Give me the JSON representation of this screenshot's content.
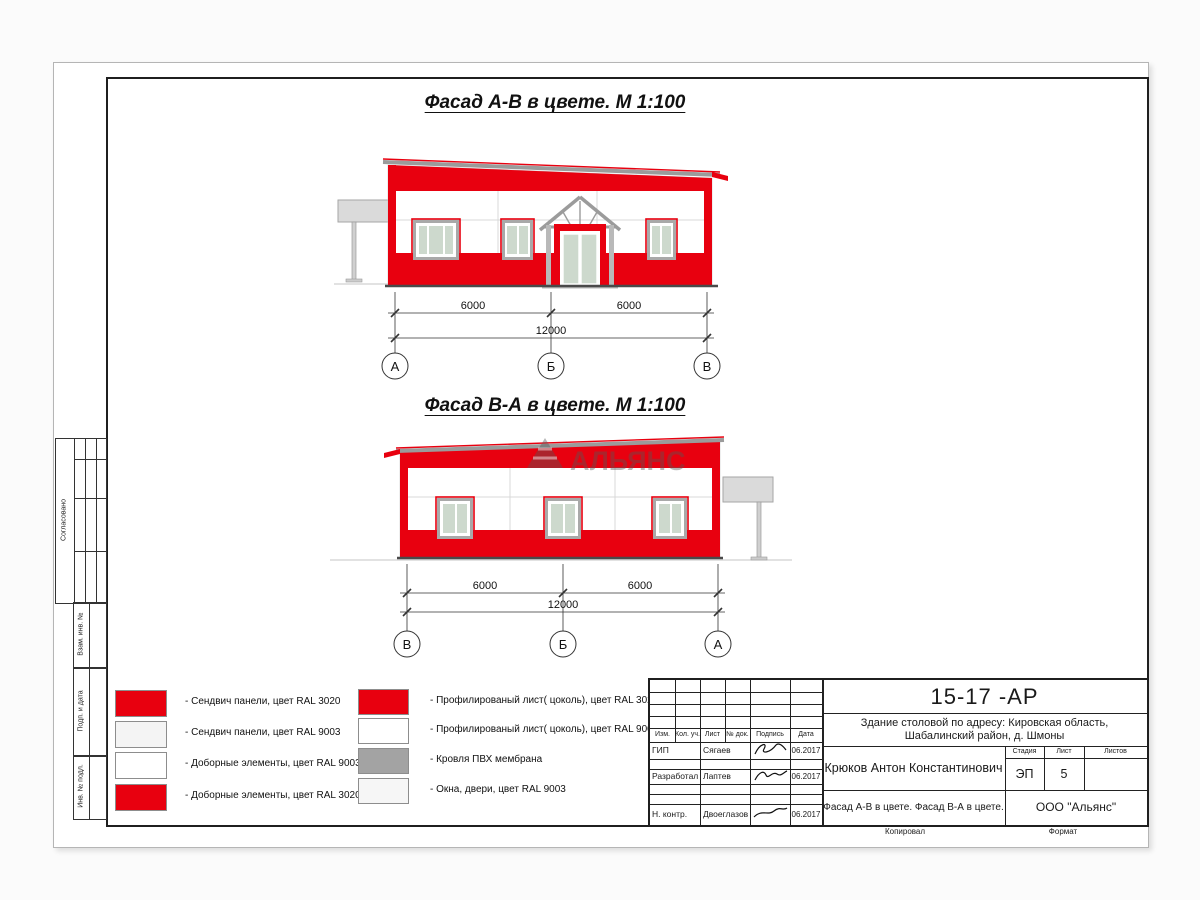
{
  "sheet": {
    "facade1": {
      "title": "Фасад А-В в цвете.  М 1:100",
      "dims": [
        "6000",
        "6000",
        "12000"
      ],
      "axes": [
        "А",
        "Б",
        "В"
      ]
    },
    "facade2": {
      "title": "Фасад В-А в цвете.  М 1:100",
      "dims": [
        "6000",
        "6000",
        "12000"
      ],
      "axes": [
        "В",
        "Б",
        "А"
      ]
    },
    "watermark": "АЛЬЯНС"
  },
  "legend": {
    "col1": [
      {
        "color": "#e8000f",
        "label": "- Сендвич панели, цвет RAL 3020"
      },
      {
        "color": "#f4f4f4",
        "label": "- Сендвич панели, цвет RAL 9003"
      },
      {
        "color": "#ffffff",
        "label": "- Доборные элементы, цвет RAL 9003"
      },
      {
        "color": "#e8000f",
        "label": "- Доборные элементы, цвет RAL 3020"
      }
    ],
    "col2": [
      {
        "color": "#e8000f",
        "label": "- Профилированый лист( цоколь), цвет RAL 3020"
      },
      {
        "color": "#ffffff",
        "label": "- Профилированый лист( цоколь), цвет RAL 9003"
      },
      {
        "color": "#a3a3a3",
        "label": "- Кровля ПВХ мембрана"
      },
      {
        "color": "#f6f6f6",
        "label": "- Окна, двери, цвет RAL 9003"
      }
    ]
  },
  "stamp": {
    "doc_number": "15-17 -АР",
    "project": "Здание столовой по адресу: Кировская область, Шабалинский район, д. Шмоны",
    "author": "Крюков Антон Константинович",
    "sheet_title": "Фасад А-В в цвете. Фасад В-А в цвете.",
    "company": "ООО \"Альянс\"",
    "stage": {
      "label": "Стадия",
      "value": "ЭП"
    },
    "sheet_no": {
      "label": "Лист",
      "value": "5"
    },
    "sheets_total": {
      "label": "Листов",
      "value": ""
    },
    "headers": [
      "Изм.",
      "Кол. уч.",
      "Лист",
      "№ док.",
      "Подпись",
      "Дата"
    ],
    "rows": [
      {
        "role": "ГИП",
        "name": "Сягаев",
        "date": "06.2017"
      },
      {
        "role": "Разработал",
        "name": "Лаптев",
        "date": "06.2017"
      },
      {
        "role": "Н. контр.",
        "name": "Двоеглазов",
        "date": "06.2017"
      }
    ],
    "footer": {
      "copied": "Копировал",
      "format": "Формат"
    }
  },
  "margin": {
    "approved": "Согласовано",
    "replace_inv": "Взам. инв. №",
    "sign_date": "Подп. и дата",
    "inv_orig": "Инв. № подл."
  },
  "colors": {
    "ral3020": "#e8000f",
    "ral9003": "#f4f4f4",
    "membrane": "#a3a3a3",
    "glass": "#cdd9cd"
  }
}
